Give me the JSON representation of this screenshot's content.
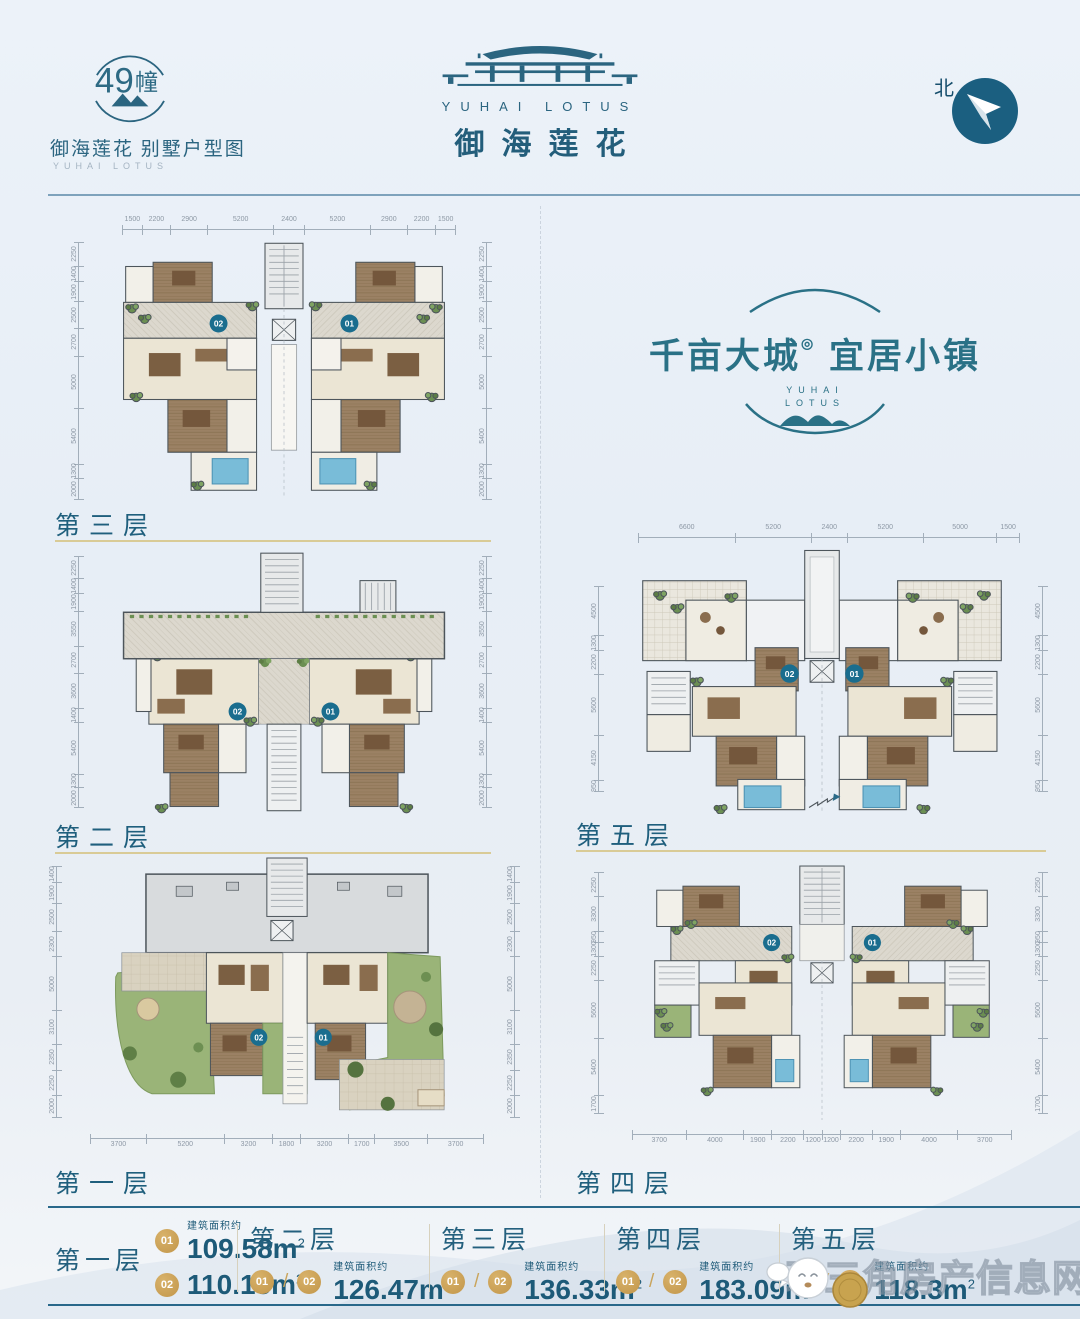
{
  "header": {
    "badge": {
      "number": "49",
      "unit": "幢",
      "line1": "御海莲花 别墅户型图",
      "line2": "YUHAI LOTUS"
    },
    "brand": {
      "en": "YUHAI LOTUS",
      "cn": "御海莲花"
    },
    "compass": {
      "label": "北"
    }
  },
  "slogan": {
    "left": "千亩大城",
    "mark": "◎",
    "right": "宜居小镇",
    "sub1": "YUHAI",
    "sub2": "LOTUS"
  },
  "floors": [
    {
      "label": "第三层",
      "units": [
        "02",
        "01"
      ],
      "dims_top": [
        "1500",
        "2200",
        "2900",
        "5200",
        "2400",
        "5200",
        "2900",
        "2200",
        "1500"
      ],
      "dims_left": [
        "2250",
        "1400",
        "1900",
        "2500",
        "2700",
        "5000",
        "5400",
        "1300",
        "2000"
      ]
    },
    {
      "label": "第二层",
      "units": [
        "02",
        "01"
      ],
      "dims_left": [
        "2250",
        "1400",
        "1900",
        "3550",
        "2700",
        "3600",
        "1400",
        "5400",
        "1300",
        "2000"
      ]
    },
    {
      "label": "第一层",
      "units": [
        "02",
        "01"
      ],
      "dims_left": [
        "1400",
        "1900",
        "2500",
        "2300",
        "5000",
        "3100",
        "2350",
        "2250",
        "2000"
      ],
      "dims_bottom": [
        "3700",
        "5200",
        "3200",
        "1800",
        "3200",
        "1700",
        "3500",
        "3700"
      ]
    },
    {
      "label": "第五层",
      "units": [
        "02",
        "01"
      ],
      "dims_top": [
        "6600",
        "5200",
        "2400",
        "5200",
        "5000",
        "1500"
      ],
      "dims_left": [
        "4500",
        "1300",
        "2200",
        "5600",
        "4150",
        "950"
      ]
    },
    {
      "label": "第四层",
      "units": [
        "02",
        "01"
      ],
      "dims_left": [
        "2250",
        "3300",
        "950",
        "1300",
        "2250",
        "5600",
        "5400",
        "1700"
      ],
      "dims_bottom": [
        "3700",
        "4000",
        "1900",
        "2200",
        "1200",
        "1200",
        "2200",
        "1900",
        "4000",
        "3700"
      ]
    }
  ],
  "legend": {
    "area_label": "建筑面积约",
    "sections": [
      {
        "floor": "第一层",
        "rows": [
          {
            "unit": "01",
            "area": "109.58m",
            "sup": "2"
          },
          {
            "unit": "02",
            "area": "110.15m",
            "sup": "2"
          }
        ]
      },
      {
        "floor": "第二层",
        "unit_a": "01",
        "unit_b": "02",
        "area": "126.47m",
        "sup": "2"
      },
      {
        "floor": "第三层",
        "unit_a": "01",
        "unit_b": "02",
        "area": "136.33m",
        "sup": "2"
      },
      {
        "floor": "第四层",
        "unit_a": "01",
        "unit_b": "02",
        "area": "183.09m",
        "sup": "2"
      },
      {
        "floor": "第五层",
        "unit_a": "01",
        "unit_b": "02",
        "area": "118.3m",
        "sup": "2"
      }
    ]
  },
  "watermark": {
    "text": "珠三角房产信息网"
  },
  "colors": {
    "accent_teal": "#1f6380",
    "gold": "#c9a45c",
    "pool_blue": "#79bcd8",
    "lawn_green": "#9ab478",
    "wood_brown": "#9b8164",
    "dim_line": "#a2aeba",
    "underline_tan": "#d9cb96"
  }
}
